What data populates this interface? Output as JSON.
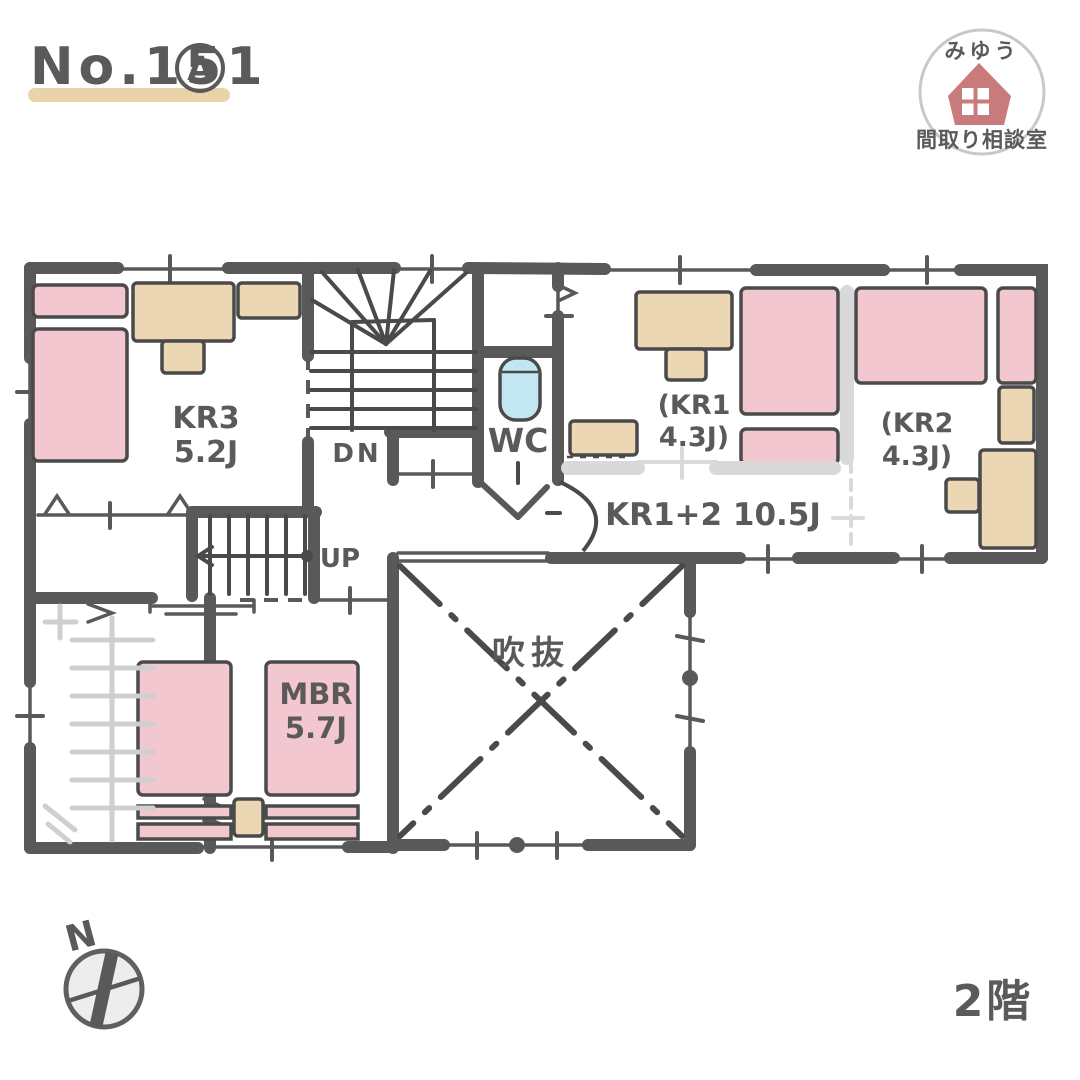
{
  "title": {
    "number": "No.151",
    "variant": "A"
  },
  "logo": {
    "top": "みゆう",
    "bottom": "間取り相談室",
    "icon": "house-icon"
  },
  "rooms": {
    "kr3": {
      "name": "KR3",
      "size": "5.2J"
    },
    "kr1": {
      "line1": "(KR1",
      "line2": "4.3J)"
    },
    "kr2": {
      "line1": "(KR2",
      "line2": "4.3J)"
    },
    "kr12": {
      "label": "KR1+2  10.5J"
    },
    "mbr": {
      "name": "MBR",
      "size": "5.7J"
    },
    "wc": {
      "label": "WC"
    },
    "void": {
      "label": "吹抜"
    }
  },
  "stairs": {
    "down": "DN",
    "up": "UP"
  },
  "compass": {
    "north": "N"
  },
  "floor": {
    "label": "2階"
  },
  "colors": {
    "wall": "#595959",
    "ink": "#4a4a4a",
    "text": "#5a5a5a",
    "pink": "#f3c7d0",
    "tan": "#ecd7b4",
    "beigeBar": "#e9d3a9",
    "grayLight": "#d9d9d9",
    "grayHanger": "#cfcfcf",
    "blue": "#c2e6f2",
    "logoPink": "#c97a7a",
    "logoBorder": "#c8c8c8",
    "compassFill": "#ededed",
    "paper": "#ffffff"
  }
}
